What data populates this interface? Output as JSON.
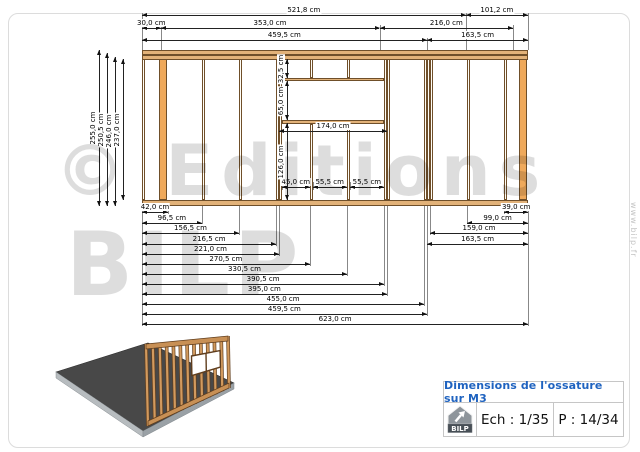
{
  "watermark": {
    "line1": "© Editions",
    "line2": "BILP",
    "website": "www.bilp.fr"
  },
  "title_block": {
    "title": "Dimensions de l'ossature sur M3",
    "scale_label": "Ech : 1/35",
    "page_label": "P : 14/34",
    "logo_text": "BILP"
  },
  "colors": {
    "wood_fill": "#e2b279",
    "stud_fill": "#fffdf6",
    "post_fill": "#efa95b",
    "outline": "#6f4f2a",
    "dim_line": "#222222",
    "title_blue": "#1f63c0",
    "platform_gray": "#484848",
    "platform_rim": "#b7bcbf",
    "logo_gray": "#8e959b",
    "logo_banner": "#474f56",
    "border_gray": "#c6c6c6"
  },
  "drawing": {
    "unit": "cm",
    "wall": {
      "width_cm": 623,
      "height_cm": 255,
      "stud_width_cm": 4.5
    },
    "studs_cm": [
      0,
      96.5,
      156.5,
      216.5,
      221,
      390.5,
      395,
      455,
      459.5,
      464,
      524,
      584
    ],
    "posts_cm": [
      {
        "x": 27.5,
        "w": 14.5
      },
      {
        "x": 608.5,
        "w": 14.5
      }
    ],
    "window": {
      "left_cm": 225.5,
      "right_cm": 390.5,
      "top_band_cm": 32.5,
      "opening_cm": 65,
      "below_cm": 126,
      "cripples_cm": [
        270.5,
        330.5
      ]
    },
    "dims_top": [
      {
        "label": "521,8 cm",
        "a": 0,
        "b": 521.8,
        "y": 15
      },
      {
        "label": "101,2 cm",
        "a": 521.8,
        "b": 623,
        "y": 15
      },
      {
        "label": "30,0 cm",
        "a": 0,
        "b": 30,
        "y": 27.5
      },
      {
        "label": "353,0 cm",
        "a": 30,
        "b": 383,
        "y": 27.5
      },
      {
        "label": "216,0 cm",
        "a": 383,
        "b": 599,
        "y": 27.5
      },
      {
        "label": "459,5 cm",
        "a": 0,
        "b": 459.5,
        "y": 40
      },
      {
        "label": "163,5 cm",
        "a": 459.5,
        "b": 623,
        "y": 40
      }
    ],
    "dims_bottom": [
      {
        "label": "42,0 cm",
        "a": 0,
        "b": 42,
        "y": 212
      },
      {
        "label": "96,5 cm",
        "a": 0,
        "b": 96.5,
        "y": 222.5
      },
      {
        "label": "156,5 cm",
        "a": 0,
        "b": 156.5,
        "y": 233
      },
      {
        "label": "216,5 cm",
        "a": 0,
        "b": 216.5,
        "y": 243.5
      },
      {
        "label": "221,0 cm",
        "a": 0,
        "b": 221,
        "y": 253.5
      },
      {
        "label": "270,5 cm",
        "a": 0,
        "b": 270.5,
        "y": 263.5
      },
      {
        "label": "330,5 cm",
        "a": 0,
        "b": 330.5,
        "y": 273.5
      },
      {
        "label": "390,5 cm",
        "a": 0,
        "b": 390.5,
        "y": 283.5
      },
      {
        "label": "395,0 cm",
        "a": 0,
        "b": 395,
        "y": 293.5
      },
      {
        "label": "455,0 cm",
        "a": 0,
        "b": 455,
        "y": 303.5
      },
      {
        "label": "459,5 cm",
        "a": 0,
        "b": 459.5,
        "y": 313.5
      },
      {
        "label": "623,0 cm",
        "a": 0,
        "b": 623,
        "y": 324
      }
    ],
    "dims_bottom_right": [
      {
        "label": "39,0 cm",
        "a": 584,
        "b": 623,
        "y": 212
      },
      {
        "label": "99,0 cm",
        "a": 524,
        "b": 623,
        "y": 222.5
      },
      {
        "label": "159,0 cm",
        "a": 464,
        "b": 623,
        "y": 233
      },
      {
        "label": "163,5 cm",
        "a": 459.5,
        "b": 623,
        "y": 243.5
      }
    ],
    "dims_left": [
      {
        "label": "255,0 cm",
        "x": 99,
        "y1": 50,
        "y2": 206
      },
      {
        "label": "250,5 cm",
        "x": 107,
        "y1": 53,
        "y2": 206
      },
      {
        "label": "246,0 cm",
        "x": 115,
        "y1": 56.5,
        "y2": 206
      },
      {
        "label": "237,0 cm",
        "x": 123,
        "y1": 59,
        "y2": 200
      }
    ],
    "dims_window_v": [
      {
        "label": "32,5 cm",
        "x": 287,
        "y1": 59,
        "y2": 78.3
      },
      {
        "label": "65,0 cm",
        "x": 287,
        "y1": 81.3,
        "y2": 119.7
      },
      {
        "label": "126,0 cm",
        "x": 287,
        "y1": 123.2,
        "y2": 200
      }
    ],
    "dims_window_h": [
      {
        "label": "174,0 cm",
        "a": 221,
        "b": 395,
        "y": 131
      },
      {
        "label": "45,0 cm",
        "a": 225.5,
        "b": 270.5,
        "y": 187
      },
      {
        "label": "55,5 cm",
        "a": 275,
        "b": 330.5,
        "y": 187
      },
      {
        "label": "55,5 cm",
        "a": 335,
        "b": 390.5,
        "y": 187
      }
    ]
  }
}
